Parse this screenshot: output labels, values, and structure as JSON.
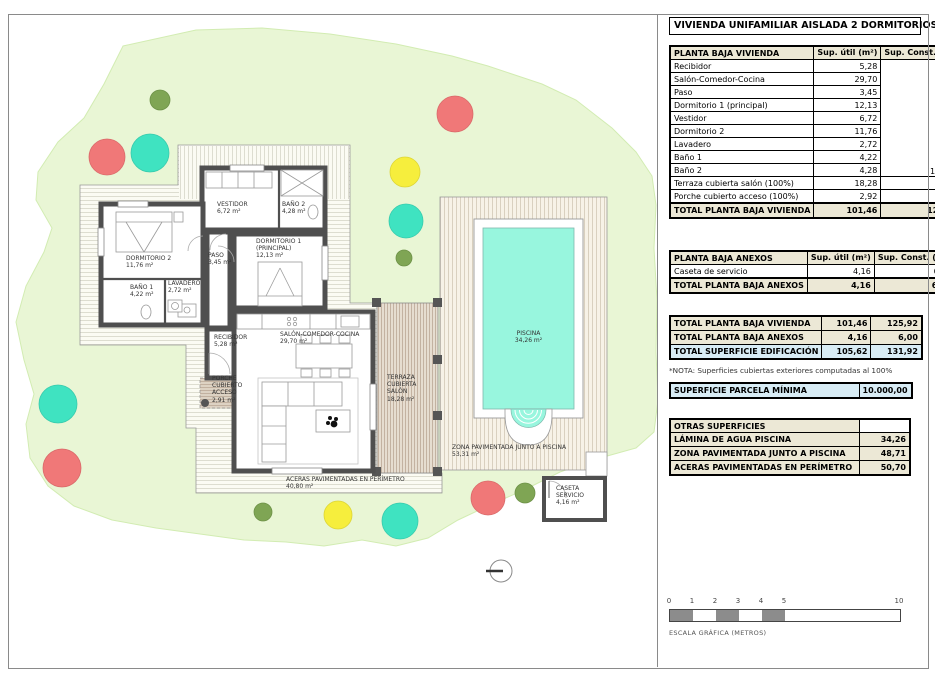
{
  "title": "VIVIENDA UNIFAMILIAR AISLADA 2 DORMITORIOS",
  "panel": {
    "vivienda": {
      "title": "PLANTA BAJA VIVIENDA",
      "col_util": "Sup. útil\n(m²)",
      "col_const": "Sup. Const.\n(m²)",
      "const_merged": "103,44",
      "rows": [
        {
          "label": "Recibidor",
          "util": "5,28"
        },
        {
          "label": "Salón-Comedor-Cocina",
          "util": "29,70"
        },
        {
          "label": "Paso",
          "util": "3,45"
        },
        {
          "label": "Dormitorio 1 (principal)",
          "util": "12,13"
        },
        {
          "label": "Vestidor",
          "util": "6,72"
        },
        {
          "label": "Dormitorio 2",
          "util": "11,76"
        },
        {
          "label": "Lavadero",
          "util": "2,72"
        },
        {
          "label": "Baño 1",
          "util": "4,22"
        },
        {
          "label": "Baño 2",
          "util": "4,28"
        },
        {
          "label": "Terraza cubierta salón (100%)",
          "util": "18,28",
          "const": "19,24"
        },
        {
          "label": "Porche cubierto acceso (100%)",
          "util": "2,92",
          "const": "3,24"
        }
      ],
      "total": {
        "label": "TOTAL PLANTA BAJA VIVIENDA",
        "util": "101,46",
        "const": "125,92"
      }
    },
    "anexos": {
      "title": "PLANTA BAJA ANEXOS",
      "col_util": "Sup. útil\n(m²)",
      "col_const": "Sup. Const.\n(m²)",
      "rows": [
        {
          "label": "Caseta de servicio",
          "util": "4,16",
          "const": "6,00"
        }
      ],
      "total": {
        "label": "TOTAL PLANTA BAJA ANEXOS",
        "util": "4,16",
        "const": "6,00"
      }
    },
    "resumen": {
      "rows": [
        {
          "label": "TOTAL PLANTA BAJA VIVIENDA",
          "util": "101,46",
          "const": "125,92"
        },
        {
          "label": "TOTAL PLANTA BAJA ANEXOS",
          "util": "4,16",
          "const": "6,00"
        },
        {
          "label": "TOTAL SUPERFICIE EDIFICACIÓN",
          "util": "105,62",
          "const": "131,92"
        }
      ]
    },
    "nota": "*NOTA: Superficies cubiertas exteriores computadas al 100%",
    "parcela": {
      "label": "SUPERFICIE PARCELA MÍNIMA",
      "value": "10.000,00"
    },
    "otras": {
      "title": "OTRAS SUPERFICIES",
      "rows": [
        {
          "label": "LÁMINA DE AGUA PISCINA",
          "value": "34,26"
        },
        {
          "label": "ZONA PAVIMENTADA JUNTO A PISCINA",
          "value": "48,71"
        },
        {
          "label": "ACERAS PAVIMENTADAS EN PERÍMETRO",
          "value": "50,70"
        }
      ]
    }
  },
  "scalebar": {
    "ticks": [
      "0",
      "1",
      "2",
      "3",
      "4",
      "5",
      "10"
    ],
    "caption": "ESCALA GRÁFICA (METROS)"
  },
  "plan": {
    "labels": {
      "vestidor": "VESTIDOR\n6,72 m²",
      "bano2": "BAÑO 2\n4,28 m²",
      "dormitorio2": "DORMITORIO 2\n11,76 m²",
      "paso": "PASO\n3,45 m²",
      "dormitorio1": "DORMITORIO 1\n(PRINCIPAL)\n12,13 m²",
      "bano1": "BAÑO 1\n4,22 m²",
      "lavadero": "LAVADERO\n2,72 m²",
      "recibidor": "RECIBIDOR\n5,28 m²",
      "salon": "SALÓN-COMEDOR-COCINA\n29,70 m²",
      "porche": "PORCHE\nCUBIERTO\nACCESO\n2,91 m²",
      "terraza": "TERRAZA\nCUBIERTA\nSALÓN\n18,28 m²",
      "aceras": "ACERAS PAVIMENTADAS EN PERÍMETRO\n40,80 m²",
      "piscina": "PISCINA\n34,26 m²",
      "zona_piscina": "ZONA PAVIMENTADA JUNTO A PISCINA\n53,31 m²",
      "caseta": "CASETA\nSERVICIO\n4,16 m²"
    }
  },
  "colors": {
    "parcel_green": "#e9f6d5",
    "pool_teal": "#98f6de",
    "wall_gray": "#4f4f4f",
    "table_beige": "#ece8d6",
    "table_blue": "#d8ecf5",
    "tree_red": "#f07878",
    "tree_teal": "#3fe3c1",
    "tree_yellow": "#f6ee3d",
    "tree_olive": "#7fa554",
    "scalebar_gray": "#8c8c8c"
  }
}
